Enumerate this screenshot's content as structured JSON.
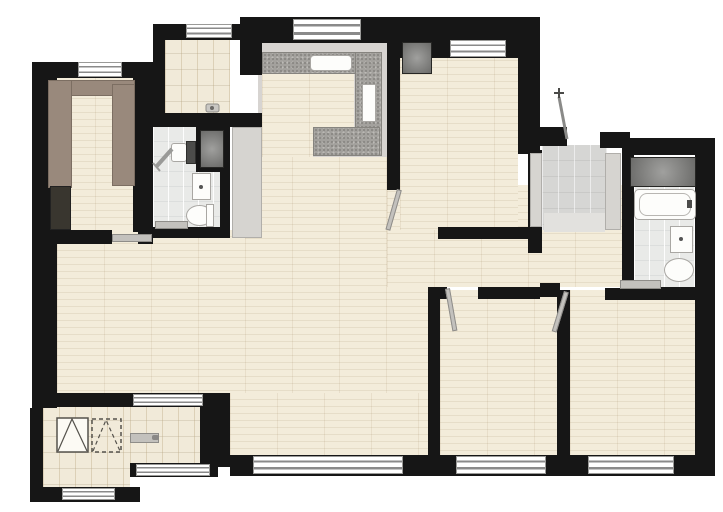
{
  "meta": {
    "type": "apartment-floor-plan",
    "visible_text": "none",
    "orientation": "top-down"
  },
  "canvas": {
    "width": 723,
    "height": 512,
    "background": "#ffffff"
  },
  "colors": {
    "wall": "#161616",
    "wood_floor": "#efe7d4",
    "beige_tile": "#f1ead9",
    "bath_tile": "#e9eae8",
    "foyer_tile": "#d6d6d4",
    "kitchen_floor": "#d7d4d1",
    "granite_counter": "#a3a19d",
    "cabinet_brown": "#99897c",
    "cabinet_dark": "#39362f",
    "shaft_gray": "#7d7d7b",
    "fixture_white": "#fdfdfb",
    "door_leaf": "#c3c1bd"
  },
  "rooms": [
    {
      "name": "walk-in-closet",
      "floor": "wood",
      "features": [
        "wardrobe-run-left",
        "wardrobe-run-top",
        "wardrobe-run-right",
        "dark-cabinet",
        "window-top"
      ]
    },
    {
      "name": "pantry-utility-room",
      "floor": "beige-tile",
      "features": [
        "window-top",
        "floor-drain-fixture",
        "opening-to-kitchen"
      ]
    },
    {
      "name": "bathroom-left",
      "floor": "white-tile",
      "features": [
        "shower-grab-bar",
        "washbasin",
        "vanity-cabinet",
        "toilet",
        "duct-shaft",
        "door-bottom"
      ]
    },
    {
      "name": "kitchen",
      "floor": "kitchen-gray-with-wood-inlay",
      "features": [
        "l-shaped-granite-counter",
        "sink",
        "island-counter",
        "tall-appliance-slot",
        "refrigerator-column",
        "window-top"
      ]
    },
    {
      "name": "bedroom-top-right",
      "floor": "wood",
      "features": [
        "window-top",
        "swing-door-bottom-left",
        "duct-shaft-in-wall"
      ]
    },
    {
      "name": "entry-foyer",
      "floor": "gray-tile",
      "features": [
        "entry-door-open-leaf",
        "shoe-cabinet-left",
        "shoe-cabinet-right"
      ]
    },
    {
      "name": "bathroom-right",
      "floor": "white-tile",
      "features": [
        "bathtub",
        "washbasin",
        "toilet",
        "duct-shaft",
        "door-bottom-left"
      ]
    },
    {
      "name": "living-dining-hall",
      "floor": "wood",
      "features": [
        "open-plan",
        "window-bottom",
        "window-to-balcony"
      ]
    },
    {
      "name": "bedroom-bottom-middle",
      "floor": "wood",
      "features": [
        "window-bottom",
        "swing-door-top-left"
      ]
    },
    {
      "name": "bedroom-bottom-right",
      "floor": "wood",
      "features": [
        "window-bottom",
        "swing-door-top-left"
      ]
    },
    {
      "name": "laundry-room",
      "floor": "beige-tile",
      "features": [
        "washing-machine-symbol-solid",
        "appliance-symbol-dashed",
        "window-bottom"
      ]
    },
    {
      "name": "balcony",
      "floor": "beige-tile",
      "features": [
        "sliding-door",
        "window-bottom"
      ]
    }
  ],
  "fixture_icons": [
    "toilet-icon",
    "bathtub-icon",
    "washbasin-icon",
    "sink-icon",
    "shower-bar-icon",
    "washing-machine-icon",
    "entry-door-swing-icon",
    "door-leaf-icon",
    "duct-shaft-icon",
    "window-icon"
  ],
  "window_count": 10,
  "door_leaf_count": 7
}
